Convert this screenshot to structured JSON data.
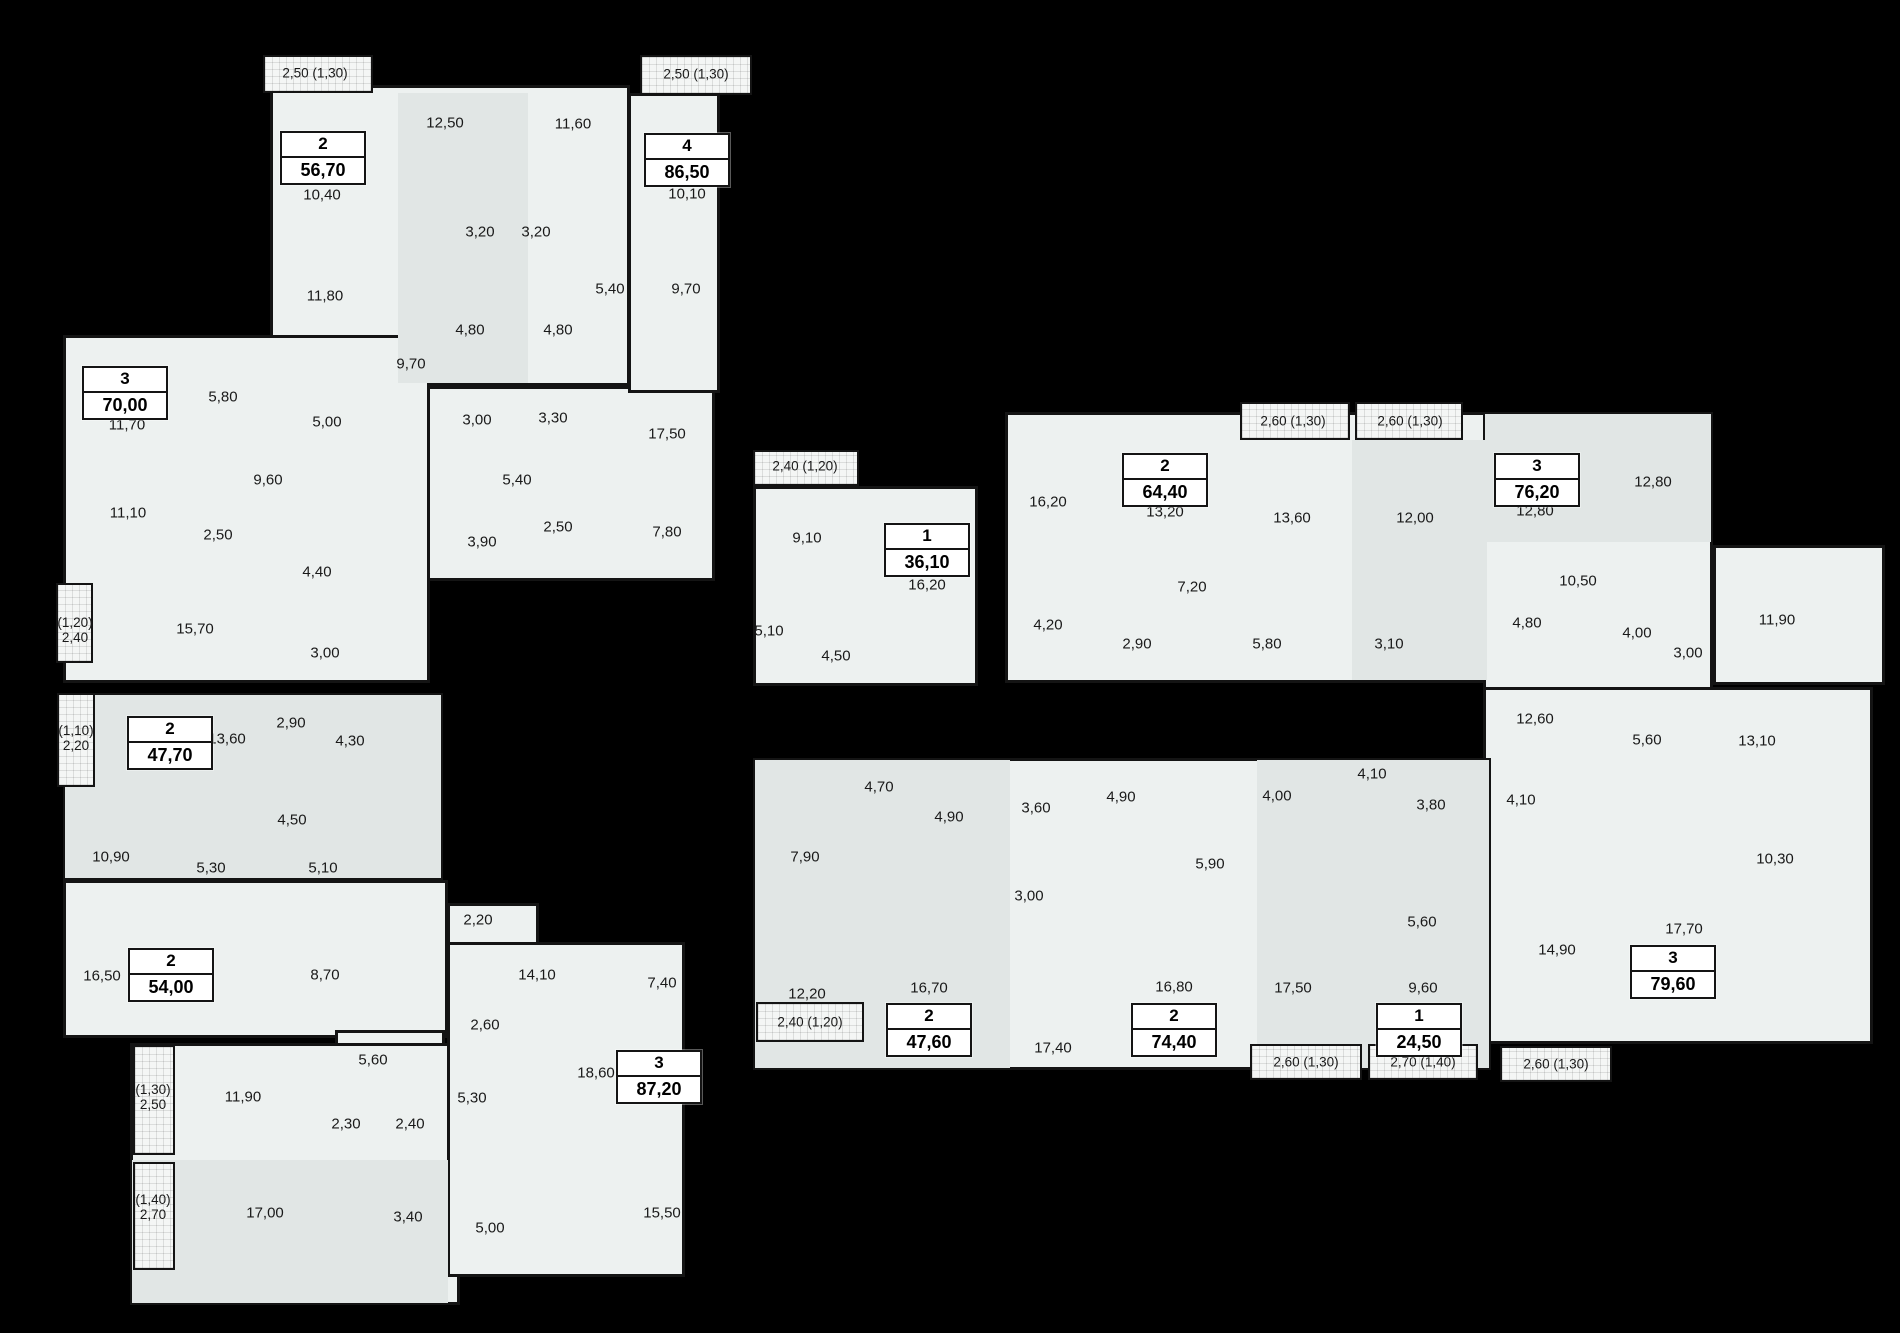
{
  "canvas": {
    "width": 1900,
    "height": 1333
  },
  "palette": {
    "background": "#000000",
    "floor": "#edf1f0",
    "floor_alt": "#e1e6e5",
    "balcony_fill": "#f4f6f5",
    "wall": "#141414",
    "ink": "#191919",
    "badge_bg": "#ffffff"
  },
  "blocks": [
    {
      "x": 270,
      "y": 85,
      "w": 360,
      "h": 301
    },
    {
      "x": 350,
      "y": 386,
      "w": 365,
      "h": 195
    },
    {
      "x": 628,
      "y": 93,
      "w": 92,
      "h": 300
    },
    {
      "x": 63,
      "y": 335,
      "w": 367,
      "h": 348
    },
    {
      "x": 63,
      "y": 693,
      "w": 380,
      "h": 187
    },
    {
      "x": 63,
      "y": 880,
      "w": 385,
      "h": 158
    },
    {
      "x": 335,
      "y": 1030,
      "w": 110,
      "h": 75
    },
    {
      "x": 130,
      "y": 1043,
      "w": 330,
      "h": 262
    },
    {
      "x": 447,
      "y": 903,
      "w": 92,
      "h": 42
    },
    {
      "x": 447,
      "y": 942,
      "w": 238,
      "h": 335
    },
    {
      "x": 753,
      "y": 486,
      "w": 225,
      "h": 200
    },
    {
      "x": 1005,
      "y": 412,
      "w": 485,
      "h": 271
    },
    {
      "x": 1483,
      "y": 412,
      "w": 230,
      "h": 278
    },
    {
      "x": 1713,
      "y": 545,
      "w": 172,
      "h": 140
    },
    {
      "x": 1483,
      "y": 687,
      "w": 390,
      "h": 357
    },
    {
      "x": 753,
      "y": 758,
      "w": 738,
      "h": 312
    }
  ],
  "shades": [
    {
      "x": 398,
      "y": 93,
      "w": 130,
      "h": 290
    },
    {
      "x": 1352,
      "y": 440,
      "w": 135,
      "h": 240
    },
    {
      "x": 755,
      "y": 760,
      "w": 255,
      "h": 308
    },
    {
      "x": 1257,
      "y": 760,
      "w": 232,
      "h": 308
    },
    {
      "x": 132,
      "y": 1160,
      "w": 316,
      "h": 143
    },
    {
      "x": 1485,
      "y": 414,
      "w": 226,
      "h": 128
    },
    {
      "x": 65,
      "y": 695,
      "w": 376,
      "h": 183
    }
  ],
  "balconies": [
    {
      "x": 263,
      "y": 55,
      "w": 110,
      "h": 38
    },
    {
      "x": 640,
      "y": 55,
      "w": 112,
      "h": 40
    },
    {
      "x": 56,
      "y": 583,
      "w": 37,
      "h": 80
    },
    {
      "x": 57,
      "y": 693,
      "w": 38,
      "h": 94
    },
    {
      "x": 133,
      "y": 1045,
      "w": 42,
      "h": 110
    },
    {
      "x": 133,
      "y": 1162,
      "w": 42,
      "h": 108
    },
    {
      "x": 753,
      "y": 450,
      "w": 106,
      "h": 36
    },
    {
      "x": 756,
      "y": 1002,
      "w": 108,
      "h": 40
    },
    {
      "x": 1240,
      "y": 402,
      "w": 110,
      "h": 38
    },
    {
      "x": 1355,
      "y": 402,
      "w": 108,
      "h": 38
    },
    {
      "x": 1250,
      "y": 1044,
      "w": 112,
      "h": 36
    },
    {
      "x": 1368,
      "y": 1044,
      "w": 110,
      "h": 36
    },
    {
      "x": 1500,
      "y": 1046,
      "w": 112,
      "h": 36
    }
  ],
  "balcony_labels": [
    {
      "t": "2,50 (1,30)",
      "x": 315,
      "y": 73
    },
    {
      "t": "2,50 (1,30)",
      "x": 696,
      "y": 74
    },
    {
      "lines": [
        "(1,20)",
        "2,40"
      ],
      "x": 75,
      "y": 630
    },
    {
      "lines": [
        "(1,10)",
        "2,20"
      ],
      "x": 76,
      "y": 738
    },
    {
      "lines": [
        "(1,30)",
        "2,50"
      ],
      "x": 153,
      "y": 1097
    },
    {
      "lines": [
        "(1,40)",
        "2,70"
      ],
      "x": 153,
      "y": 1207
    },
    {
      "t": "2,40 (1,20)",
      "x": 805,
      "y": 466
    },
    {
      "t": "2,40 (1,20)",
      "x": 810,
      "y": 1022
    },
    {
      "t": "2,60 (1,30)",
      "x": 1293,
      "y": 421
    },
    {
      "t": "2,60 (1,30)",
      "x": 1410,
      "y": 421
    },
    {
      "t": "2,60 (1,30)",
      "x": 1306,
      "y": 1062
    },
    {
      "t": "2,70 (1,40)",
      "x": 1423,
      "y": 1062
    },
    {
      "t": "2,60 (1,30)",
      "x": 1556,
      "y": 1064
    }
  ],
  "apartments": [
    {
      "n": "2",
      "a": "56,70",
      "x": 323,
      "y": 158
    },
    {
      "n": "4",
      "a": "86,50",
      "x": 687,
      "y": 160
    },
    {
      "n": "3",
      "a": "70,00",
      "x": 125,
      "y": 393
    },
    {
      "n": "2",
      "a": "47,70",
      "x": 170,
      "y": 743
    },
    {
      "n": "2",
      "a": "54,00",
      "x": 171,
      "y": 975
    },
    {
      "n": "3",
      "a": "87,20",
      "x": 659,
      "y": 1077
    },
    {
      "n": "1",
      "a": "36,10",
      "x": 927,
      "y": 550
    },
    {
      "n": "2",
      "a": "64,40",
      "x": 1165,
      "y": 480
    },
    {
      "n": "3",
      "a": "76,20",
      "x": 1537,
      "y": 480
    },
    {
      "n": "2",
      "a": "47,60",
      "x": 929,
      "y": 1030
    },
    {
      "n": "2",
      "a": "74,40",
      "x": 1174,
      "y": 1030
    },
    {
      "n": "1",
      "a": "24,50",
      "x": 1419,
      "y": 1030
    },
    {
      "n": "3",
      "a": "79,60",
      "x": 1673,
      "y": 972
    }
  ],
  "room_labels": [
    {
      "t": "12,50",
      "x": 445,
      "y": 123
    },
    {
      "t": "11,60",
      "x": 573,
      "y": 124
    },
    {
      "t": "10,40",
      "x": 322,
      "y": 195
    },
    {
      "t": "10,10",
      "x": 687,
      "y": 194
    },
    {
      "t": "3,20",
      "x": 480,
      "y": 232
    },
    {
      "t": "3,20",
      "x": 536,
      "y": 232
    },
    {
      "t": "11,80",
      "x": 325,
      "y": 296
    },
    {
      "t": "5,40",
      "x": 610,
      "y": 289
    },
    {
      "t": "9,70",
      "x": 686,
      "y": 289
    },
    {
      "t": "4,80",
      "x": 470,
      "y": 330
    },
    {
      "t": "4,80",
      "x": 558,
      "y": 330
    },
    {
      "t": "9,70",
      "x": 411,
      "y": 364
    },
    {
      "t": "3,00",
      "x": 477,
      "y": 420
    },
    {
      "t": "3,30",
      "x": 553,
      "y": 418
    },
    {
      "t": "17,50",
      "x": 667,
      "y": 434
    },
    {
      "t": "5,40",
      "x": 517,
      "y": 480
    },
    {
      "t": "2,50",
      "x": 558,
      "y": 527
    },
    {
      "t": "3,90",
      "x": 482,
      "y": 542
    },
    {
      "t": "7,80",
      "x": 667,
      "y": 532
    },
    {
      "t": "11,70",
      "x": 127,
      "y": 425
    },
    {
      "t": "5,80",
      "x": 223,
      "y": 397
    },
    {
      "t": "5,00",
      "x": 327,
      "y": 422
    },
    {
      "t": "9,60",
      "x": 268,
      "y": 480
    },
    {
      "t": "11,10",
      "x": 128,
      "y": 513
    },
    {
      "t": "2,50",
      "x": 218,
      "y": 535
    },
    {
      "t": "4,40",
      "x": 317,
      "y": 572
    },
    {
      "t": "15,70",
      "x": 195,
      "y": 629
    },
    {
      "t": "3,00",
      "x": 325,
      "y": 653
    },
    {
      "t": "13,60",
      "x": 227,
      "y": 739
    },
    {
      "t": "2,90",
      "x": 291,
      "y": 723
    },
    {
      "t": "4,30",
      "x": 350,
      "y": 741
    },
    {
      "t": "4,50",
      "x": 292,
      "y": 820
    },
    {
      "t": "10,90",
      "x": 111,
      "y": 857
    },
    {
      "t": "5,30",
      "x": 211,
      "y": 868
    },
    {
      "t": "5,10",
      "x": 323,
      "y": 868
    },
    {
      "t": "16,50",
      "x": 102,
      "y": 976
    },
    {
      "t": "8,70",
      "x": 325,
      "y": 975
    },
    {
      "t": "5,60",
      "x": 373,
      "y": 1060
    },
    {
      "t": "11,90",
      "x": 243,
      "y": 1097
    },
    {
      "t": "2,30",
      "x": 346,
      "y": 1124
    },
    {
      "t": "2,40",
      "x": 410,
      "y": 1124
    },
    {
      "t": "17,00",
      "x": 265,
      "y": 1213
    },
    {
      "t": "3,40",
      "x": 408,
      "y": 1217
    },
    {
      "t": "2,20",
      "x": 478,
      "y": 920
    },
    {
      "t": "14,10",
      "x": 537,
      "y": 975
    },
    {
      "t": "7,40",
      "x": 662,
      "y": 983
    },
    {
      "t": "2,60",
      "x": 485,
      "y": 1025
    },
    {
      "t": "18,60",
      "x": 596,
      "y": 1073
    },
    {
      "t": "5,30",
      "x": 472,
      "y": 1098
    },
    {
      "t": "5,00",
      "x": 490,
      "y": 1228
    },
    {
      "t": "15,50",
      "x": 662,
      "y": 1213
    },
    {
      "t": "9,10",
      "x": 807,
      "y": 538
    },
    {
      "t": "16,20",
      "x": 927,
      "y": 585
    },
    {
      "t": "5,10",
      "x": 769,
      "y": 631
    },
    {
      "t": "4,50",
      "x": 836,
      "y": 656
    },
    {
      "t": "16,20",
      "x": 1048,
      "y": 502
    },
    {
      "t": "13,20",
      "x": 1165,
      "y": 512
    },
    {
      "t": "13,60",
      "x": 1292,
      "y": 518
    },
    {
      "t": "12,00",
      "x": 1415,
      "y": 518
    },
    {
      "t": "7,20",
      "x": 1192,
      "y": 587
    },
    {
      "t": "4,20",
      "x": 1048,
      "y": 625
    },
    {
      "t": "2,90",
      "x": 1137,
      "y": 644
    },
    {
      "t": "5,80",
      "x": 1267,
      "y": 644
    },
    {
      "t": "3,10",
      "x": 1389,
      "y": 644
    },
    {
      "t": "12,80",
      "x": 1535,
      "y": 511
    },
    {
      "t": "12,80",
      "x": 1653,
      "y": 482
    },
    {
      "t": "10,50",
      "x": 1578,
      "y": 581
    },
    {
      "t": "11,90",
      "x": 1777,
      "y": 620
    },
    {
      "t": "4,80",
      "x": 1527,
      "y": 623
    },
    {
      "t": "4,00",
      "x": 1637,
      "y": 633
    },
    {
      "t": "3,00",
      "x": 1688,
      "y": 653
    },
    {
      "t": "12,60",
      "x": 1535,
      "y": 719
    },
    {
      "t": "5,60",
      "x": 1647,
      "y": 740
    },
    {
      "t": "13,10",
      "x": 1757,
      "y": 741
    },
    {
      "t": "4,10",
      "x": 1521,
      "y": 800
    },
    {
      "t": "10,30",
      "x": 1775,
      "y": 859
    },
    {
      "t": "14,90",
      "x": 1557,
      "y": 950
    },
    {
      "t": "17,70",
      "x": 1684,
      "y": 929
    },
    {
      "t": "4,70",
      "x": 879,
      "y": 787
    },
    {
      "t": "7,90",
      "x": 805,
      "y": 857
    },
    {
      "t": "4,90",
      "x": 949,
      "y": 817
    },
    {
      "t": "3,60",
      "x": 1036,
      "y": 808
    },
    {
      "t": "4,90",
      "x": 1121,
      "y": 797
    },
    {
      "t": "3,00",
      "x": 1029,
      "y": 896
    },
    {
      "t": "12,20",
      "x": 807,
      "y": 994
    },
    {
      "t": "16,70",
      "x": 929,
      "y": 988
    },
    {
      "t": "17,40",
      "x": 1053,
      "y": 1048
    },
    {
      "t": "5,90",
      "x": 1210,
      "y": 864
    },
    {
      "t": "16,80",
      "x": 1174,
      "y": 987
    },
    {
      "t": "4,00",
      "x": 1277,
      "y": 796
    },
    {
      "t": "17,50",
      "x": 1293,
      "y": 988
    },
    {
      "t": "4,10",
      "x": 1372,
      "y": 774
    },
    {
      "t": "3,80",
      "x": 1431,
      "y": 805
    },
    {
      "t": "5,60",
      "x": 1422,
      "y": 922
    },
    {
      "t": "9,60",
      "x": 1423,
      "y": 988
    }
  ]
}
